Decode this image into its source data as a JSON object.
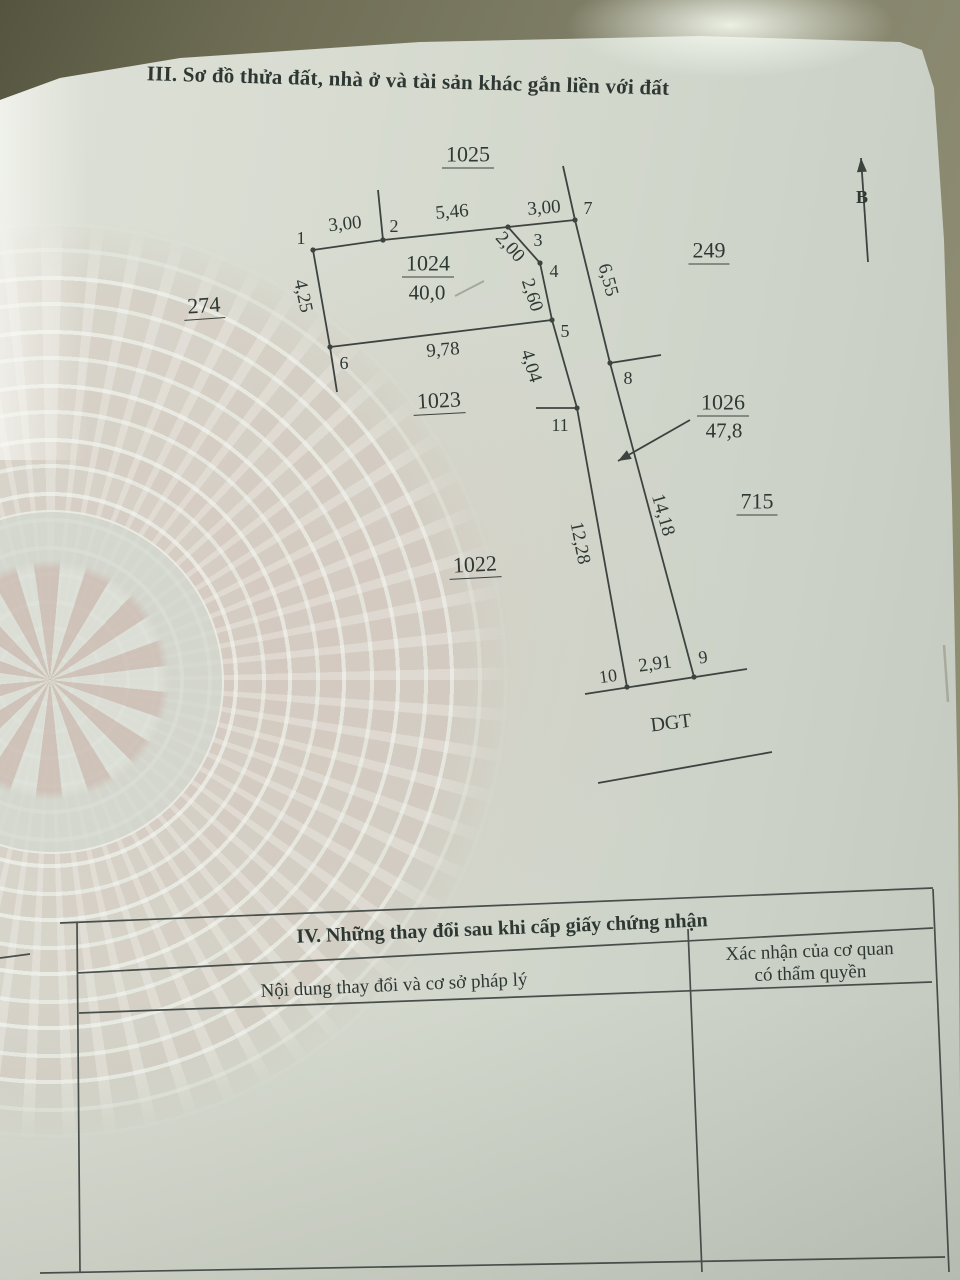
{
  "document": {
    "section_iii_title": "III. Sơ đồ thửa đất, nhà ở và tài sản khác gắn liền với đất",
    "section_iv": {
      "title": "IV. Những thay đổi sau khi cấp giấy chứng nhận",
      "col_left_header": "Nội dung thay đổi và cơ sở pháp lý",
      "col_right_header_line1": "Xác nhận của cơ quan",
      "col_right_header_line2": "có thẩm quyền"
    }
  },
  "diagram": {
    "labels": [
      {
        "name": "parcel-label-1025",
        "text": "1025",
        "x": 468,
        "y": 156,
        "size": 22,
        "underline": true
      },
      {
        "name": "parcel-label-249",
        "text": "249",
        "x": 709,
        "y": 252,
        "size": 22,
        "underline": true
      },
      {
        "name": "parcel-label-274",
        "text": "274",
        "x": 204,
        "y": 307,
        "size": 22,
        "rot": -4,
        "underline": true
      },
      {
        "name": "parcel-label-1023",
        "text": "1023",
        "x": 439,
        "y": 402,
        "size": 22,
        "rot": -3,
        "underline": true
      },
      {
        "name": "parcel-label-1022",
        "text": "1022",
        "x": 475,
        "y": 566,
        "size": 22,
        "rot": -3,
        "underline": true
      },
      {
        "name": "parcel-label-715",
        "text": "715",
        "x": 757,
        "y": 503,
        "size": 22,
        "underline": true
      },
      {
        "name": "parcel-label-1024",
        "text": "1024",
        "x": 428,
        "y": 265,
        "size": 22,
        "underline": true
      },
      {
        "name": "parcel-area-1024",
        "text": "40,0",
        "x": 427,
        "y": 293,
        "size": 21
      },
      {
        "name": "parcel-label-1026",
        "text": "1026",
        "x": 723,
        "y": 404,
        "size": 22,
        "underline": true
      },
      {
        "name": "parcel-area-1026",
        "text": "47,8",
        "x": 724,
        "y": 431,
        "size": 21
      },
      {
        "name": "road-label-dgt",
        "text": "DGT",
        "x": 671,
        "y": 723,
        "size": 20,
        "rot": -7
      },
      {
        "name": "north-label",
        "text": "B",
        "x": 862,
        "y": 197,
        "size": 18,
        "bold": true
      },
      {
        "name": "vertex-label-1",
        "text": "1",
        "x": 301,
        "y": 238,
        "size": 18
      },
      {
        "name": "vertex-label-2",
        "text": "2",
        "x": 394,
        "y": 226,
        "size": 18
      },
      {
        "name": "vertex-label-3",
        "text": "3",
        "x": 538,
        "y": 240,
        "size": 18
      },
      {
        "name": "vertex-label-4",
        "text": "4",
        "x": 554,
        "y": 271,
        "size": 18
      },
      {
        "name": "vertex-label-5",
        "text": "5",
        "x": 565,
        "y": 331,
        "size": 18
      },
      {
        "name": "vertex-label-6",
        "text": "6",
        "x": 344,
        "y": 363,
        "size": 18
      },
      {
        "name": "vertex-label-7",
        "text": "7",
        "x": 588,
        "y": 208,
        "size": 18
      },
      {
        "name": "vertex-label-8",
        "text": "8",
        "x": 628,
        "y": 378,
        "size": 18
      },
      {
        "name": "vertex-label-9",
        "text": "9",
        "x": 703,
        "y": 657,
        "size": 18,
        "rot": -8
      },
      {
        "name": "vertex-label-10",
        "text": "10",
        "x": 608,
        "y": 676,
        "size": 18,
        "rot": -8
      },
      {
        "name": "vertex-label-11",
        "text": "11",
        "x": 560,
        "y": 425,
        "size": 18
      },
      {
        "name": "measure-1-2",
        "text": "3,00",
        "x": 345,
        "y": 224,
        "size": 19,
        "rot": -6
      },
      {
        "name": "measure-2-3",
        "text": "5,46",
        "x": 452,
        "y": 212,
        "size": 19,
        "rot": -5
      },
      {
        "name": "measure-3-7",
        "text": "3,00",
        "x": 544,
        "y": 208,
        "size": 19,
        "rot": -5
      },
      {
        "name": "measure-3-4",
        "text": "2,00",
        "x": 510,
        "y": 247,
        "size": 19,
        "rot": 48
      },
      {
        "name": "measure-4-5",
        "text": "2,60",
        "x": 532,
        "y": 295,
        "size": 19,
        "rot": 72
      },
      {
        "name": "measure-1-6",
        "text": "4,25",
        "x": 303,
        "y": 296,
        "size": 19,
        "rot": 78
      },
      {
        "name": "measure-6-5",
        "text": "9,78",
        "x": 443,
        "y": 350,
        "size": 19,
        "rot": -5
      },
      {
        "name": "measure-5-11",
        "text": "4,04",
        "x": 531,
        "y": 366,
        "size": 19,
        "rot": 73
      },
      {
        "name": "measure-7-8",
        "text": "6,55",
        "x": 608,
        "y": 280,
        "size": 19,
        "rot": 75
      },
      {
        "name": "measure-11-10",
        "text": "12,28",
        "x": 580,
        "y": 543,
        "size": 19,
        "rot": 79
      },
      {
        "name": "measure-8-9",
        "text": "14,18",
        "x": 663,
        "y": 515,
        "size": 19,
        "rot": 74
      },
      {
        "name": "measure-10-9",
        "text": "2,91",
        "x": 655,
        "y": 664,
        "size": 19,
        "rot": -8
      }
    ],
    "segments": [
      [
        313,
        250,
        383,
        240
      ],
      [
        383,
        240,
        508,
        227
      ],
      [
        508,
        227,
        575,
        220
      ],
      [
        383,
        240,
        378,
        190
      ],
      [
        575,
        220,
        563,
        166
      ],
      [
        508,
        227,
        540,
        263
      ],
      [
        540,
        263,
        552,
        320
      ],
      [
        552,
        320,
        330,
        347
      ],
      [
        313,
        250,
        330,
        347
      ],
      [
        330,
        347,
        337,
        392
      ],
      [
        552,
        320,
        577,
        408
      ],
      [
        577,
        408,
        627,
        687
      ],
      [
        575,
        220,
        610,
        363
      ],
      [
        610,
        363,
        694,
        677
      ],
      [
        536,
        408,
        577,
        408
      ],
      [
        610,
        363,
        661,
        355
      ],
      [
        585,
        694,
        747,
        669
      ],
      [
        598,
        783,
        772,
        752
      ],
      [
        690,
        420,
        618,
        461
      ],
      [
        868,
        262,
        861,
        158
      ]
    ],
    "vertices_px": [
      [
        313,
        250
      ],
      [
        383,
        240
      ],
      [
        508,
        227
      ],
      [
        575,
        220
      ],
      [
        540,
        263
      ],
      [
        552,
        320
      ],
      [
        330,
        347
      ],
      [
        577,
        408
      ],
      [
        610,
        363
      ],
      [
        627,
        687
      ],
      [
        694,
        677
      ]
    ],
    "arrows": [
      {
        "x": 618,
        "y": 461,
        "angle": 150.4,
        "len": 13,
        "half": 5
      },
      {
        "x": 861,
        "y": 158,
        "angle": -93.8,
        "len": 14,
        "half": 5
      }
    ]
  },
  "colors": {
    "ink": "#2e3833",
    "line": "#3d4440",
    "paper": "#d3d8cd",
    "background_olive": "#7d7c62",
    "watermark_pink": "#cfc0b6"
  }
}
